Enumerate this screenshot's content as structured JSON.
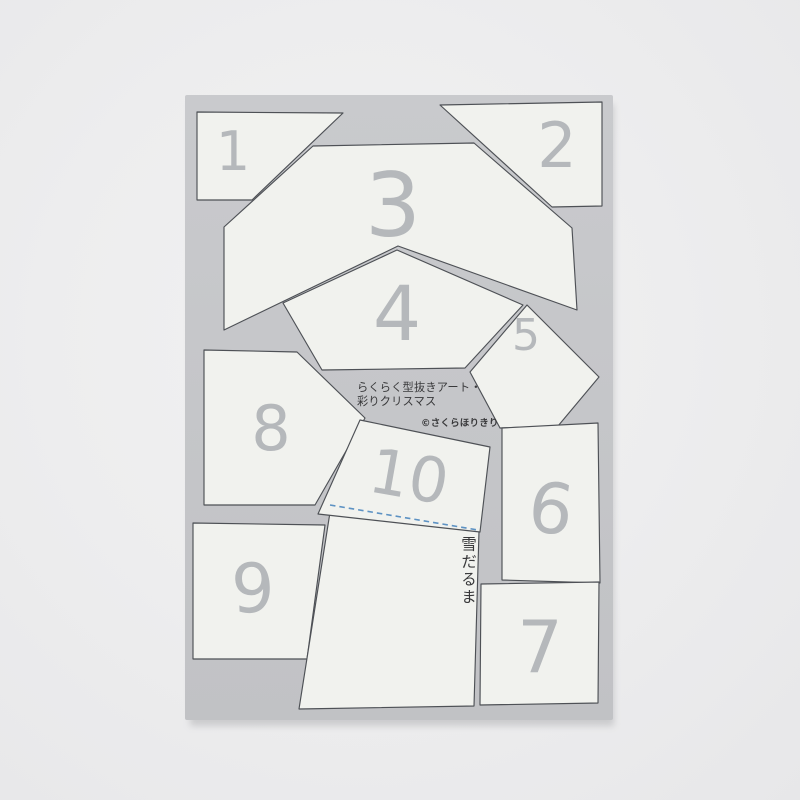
{
  "scene": {
    "type": "photograph",
    "subject": "gray die-cut craft template sheet with ten numbered white punch-out pieces"
  },
  "sheet": {
    "product_name_line1": "らくらく型抜きアート・",
    "product_name_line2": "彩りクリスマス",
    "copyright": "©さくらほりきり",
    "kit_label": "雪だるま",
    "piece_numbers": [
      "1",
      "2",
      "3",
      "4",
      "5",
      "6",
      "7",
      "8",
      "9",
      "10"
    ]
  },
  "colors": {
    "photo_background": "#ededee",
    "sheet_gray": "#c5c6c8",
    "piece_white": "#f1f2ee",
    "piece_outline": "#4e5156",
    "number_gray": "#b5b8bb",
    "text_dark": "#39393b",
    "fold_line_blue": "#5d92c3"
  }
}
